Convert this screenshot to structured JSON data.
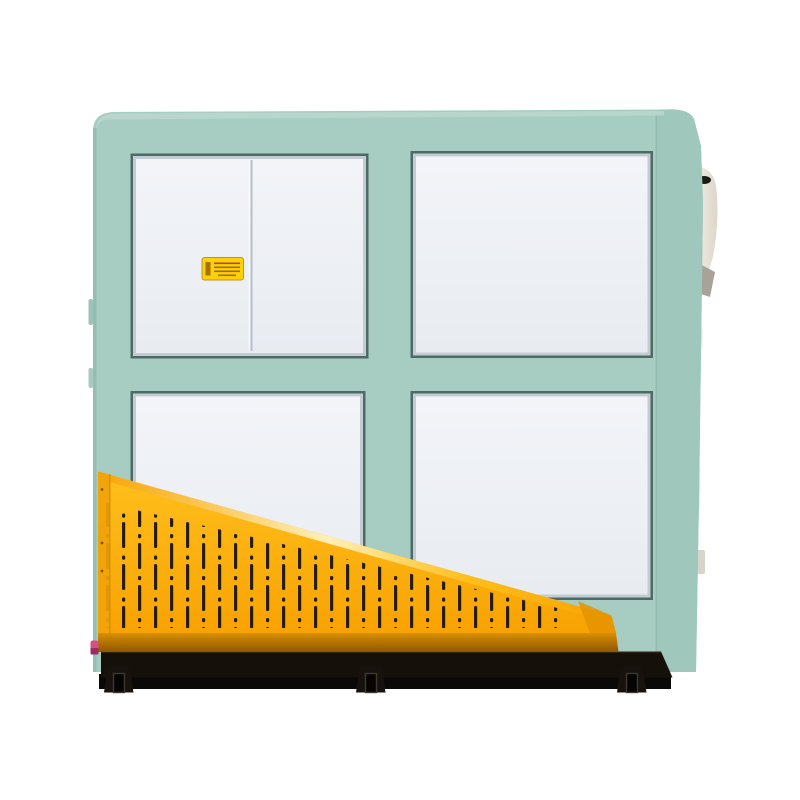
{
  "scene": {
    "alt": "Catalog product photograph of an industrial machine: a mint-green sheet-metal cabinet with four white access panels in a 2x2 grid, a small yellow warning sticker on the upper-left sliding door, a yellow triangular perforated safety guard across the lower front, and a black base rail with three mounting feet. Small white auxiliary fittings protrude from the right side.",
    "background": "#ffffff"
  },
  "machine": {
    "panel_layout": "2x2",
    "panel_count": 4,
    "upper_left_panel": "two sliding doors with center divider",
    "guard": "triangular perforated safety guard",
    "warning_label": "small yellow safety sticker, text illegible",
    "base": "black base rail with three feet"
  },
  "colors": {
    "teal": "#a7cdc2",
    "teal_light": "#bcdacf",
    "teal_side": "#9fc7bc",
    "teal_edge": "#92b9ae",
    "frame_line": "#4e6a66",
    "panel_metal": "#c2ccd2",
    "panel_face": "#f2f4f8",
    "panel_face2": "#e8ecf1",
    "divider": "#b7bfc8",
    "guard_yellow": "#ffc01c",
    "guard_yellow_deep": "#f7a303",
    "guard_highlight": "#fff3c0",
    "guard_left_flange": "#f0a30a",
    "guard_tip": "#e59300",
    "flange_top": "#d88f02",
    "flange_bottom": "#8f5700",
    "slot": "#2b1c05",
    "base_black": "#16100a",
    "base_shadow": "#0b0907",
    "foot": "#17120d",
    "foot_notch": "#3f382e",
    "label_yellow": "#ffd008",
    "label_border": "#c09126",
    "label_mark": "#a06c10",
    "label_mark_red": "#a84d22",
    "red_dot": "#c4524a",
    "pink": "#d84f86",
    "equip_white": "#f4f1ea",
    "equip_white2": "#ddd6c9",
    "equip_gray": "#a9a299",
    "equip_tab": "#d8d4cc",
    "dark_mark": "#1c1a16"
  }
}
